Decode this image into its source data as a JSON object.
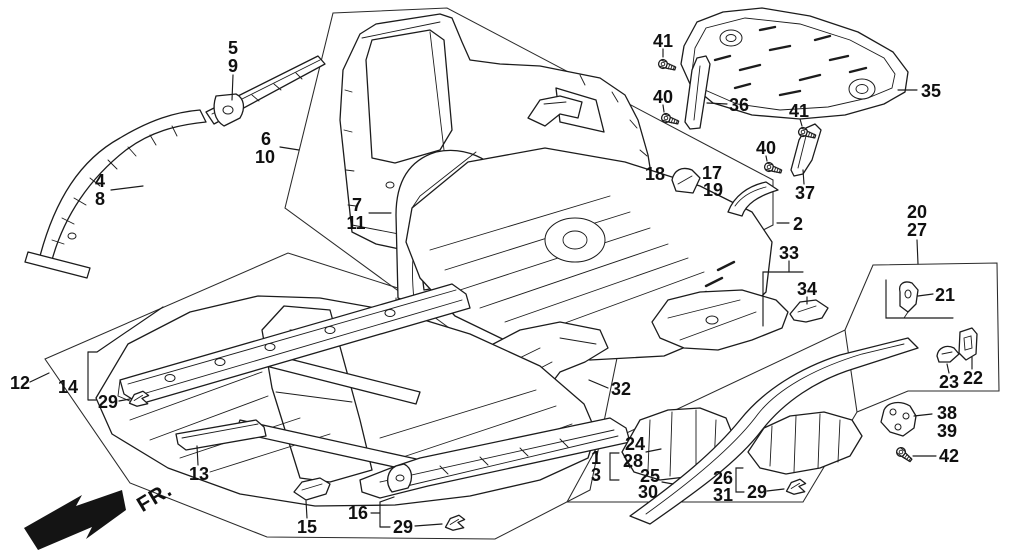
{
  "diagram": {
    "background": "#ffffff",
    "ink_color": "#1c1c1c",
    "fr_label": "FR.",
    "callouts": [
      {
        "id": "5",
        "text": "5",
        "x": 233,
        "y": 48
      },
      {
        "id": "9",
        "text": "9",
        "x": 233,
        "y": 66
      },
      {
        "id": "4",
        "text": "4",
        "x": 100,
        "y": 181
      },
      {
        "id": "8",
        "text": "8",
        "x": 100,
        "y": 199
      },
      {
        "id": "6",
        "text": "6",
        "x": 266,
        "y": 139
      },
      {
        "id": "10",
        "text": "10",
        "x": 265,
        "y": 157
      },
      {
        "id": "7",
        "text": "7",
        "x": 357,
        "y": 205
      },
      {
        "id": "11",
        "text": "11",
        "x": 356,
        "y": 223
      },
      {
        "id": "12",
        "text": "12",
        "x": 20,
        "y": 383
      },
      {
        "id": "14",
        "text": "14",
        "x": 68,
        "y": 387
      },
      {
        "id": "29a",
        "text": "29",
        "x": 108,
        "y": 402
      },
      {
        "id": "13",
        "text": "13",
        "x": 199,
        "y": 474
      },
      {
        "id": "15",
        "text": "15",
        "x": 307,
        "y": 527
      },
      {
        "id": "16",
        "text": "16",
        "x": 358,
        "y": 513
      },
      {
        "id": "29b",
        "text": "29",
        "x": 403,
        "y": 527
      },
      {
        "id": "41a",
        "text": "41",
        "x": 663,
        "y": 41
      },
      {
        "id": "40a",
        "text": "40",
        "x": 663,
        "y": 97
      },
      {
        "id": "36",
        "text": "36",
        "x": 739,
        "y": 105
      },
      {
        "id": "35",
        "text": "35",
        "x": 931,
        "y": 91
      },
      {
        "id": "41b",
        "text": "41",
        "x": 799,
        "y": 111
      },
      {
        "id": "40b",
        "text": "40",
        "x": 766,
        "y": 148
      },
      {
        "id": "37",
        "text": "37",
        "x": 805,
        "y": 193
      },
      {
        "id": "18",
        "text": "18",
        "x": 655,
        "y": 174
      },
      {
        "id": "17",
        "text": "17",
        "x": 712,
        "y": 173
      },
      {
        "id": "19",
        "text": "19",
        "x": 713,
        "y": 190
      },
      {
        "id": "2",
        "text": "2",
        "x": 798,
        "y": 224
      },
      {
        "id": "33",
        "text": "33",
        "x": 789,
        "y": 253
      },
      {
        "id": "34",
        "text": "34",
        "x": 807,
        "y": 289
      },
      {
        "id": "20",
        "text": "20",
        "x": 917,
        "y": 212
      },
      {
        "id": "27",
        "text": "27",
        "x": 917,
        "y": 230
      },
      {
        "id": "21",
        "text": "21",
        "x": 945,
        "y": 295
      },
      {
        "id": "23",
        "text": "23",
        "x": 949,
        "y": 382
      },
      {
        "id": "22",
        "text": "22",
        "x": 973,
        "y": 378
      },
      {
        "id": "38",
        "text": "38",
        "x": 947,
        "y": 413
      },
      {
        "id": "39",
        "text": "39",
        "x": 947,
        "y": 431
      },
      {
        "id": "42",
        "text": "42",
        "x": 949,
        "y": 456
      },
      {
        "id": "32",
        "text": "32",
        "x": 621,
        "y": 389
      },
      {
        "id": "1",
        "text": "1",
        "x": 596,
        "y": 458
      },
      {
        "id": "3",
        "text": "3",
        "x": 596,
        "y": 475
      },
      {
        "id": "24",
        "text": "24",
        "x": 635,
        "y": 444
      },
      {
        "id": "28",
        "text": "28",
        "x": 633,
        "y": 461
      },
      {
        "id": "25",
        "text": "25",
        "x": 650,
        "y": 476
      },
      {
        "id": "30",
        "text": "30",
        "x": 648,
        "y": 492
      },
      {
        "id": "26",
        "text": "26",
        "x": 723,
        "y": 478
      },
      {
        "id": "31",
        "text": "31",
        "x": 723,
        "y": 495
      },
      {
        "id": "29c",
        "text": "29",
        "x": 757,
        "y": 492
      }
    ],
    "leader_lines": [
      {
        "pts": [
          [
            233,
            75
          ],
          [
            232,
            100
          ]
        ]
      },
      {
        "pts": [
          [
            111,
            190
          ],
          [
            143,
            186
          ]
        ]
      },
      {
        "pts": [
          [
            280,
            147
          ],
          [
            299,
            150
          ]
        ]
      },
      {
        "pts": [
          [
            369,
            213
          ],
          [
            391,
            213
          ]
        ]
      },
      {
        "pts": [
          [
            30,
            382
          ],
          [
            49,
            373
          ]
        ]
      },
      {
        "pts": [
          [
            88,
            352
          ],
          [
            88,
            400
          ]
        ]
      },
      {
        "pts": [
          [
            88,
            352
          ],
          [
            97,
            352
          ],
          [
            163,
            307
          ]
        ]
      },
      {
        "pts": [
          [
            88,
            400
          ],
          [
            96,
            400
          ]
        ]
      },
      {
        "pts": [
          [
            119,
            401
          ],
          [
            130,
            399
          ]
        ]
      },
      {
        "pts": [
          [
            198,
            465
          ],
          [
            197,
            446
          ]
        ]
      },
      {
        "pts": [
          [
            307,
            518
          ],
          [
            306,
            501
          ]
        ]
      },
      {
        "pts": [
          [
            371,
            513
          ],
          [
            380,
            513
          ]
        ]
      },
      {
        "pts": [
          [
            380,
            502
          ],
          [
            380,
            527
          ]
        ]
      },
      {
        "pts": [
          [
            380,
            502
          ],
          [
            394,
            497
          ]
        ]
      },
      {
        "pts": [
          [
            380,
            527
          ],
          [
            390,
            527
          ]
        ]
      },
      {
        "pts": [
          [
            415,
            526
          ],
          [
            442,
            524
          ]
        ]
      },
      {
        "pts": [
          [
            663,
            49
          ],
          [
            663,
            57
          ]
        ]
      },
      {
        "pts": [
          [
            663,
            105
          ],
          [
            664,
            112
          ]
        ]
      },
      {
        "pts": [
          [
            727,
            104
          ],
          [
            707,
            103
          ]
        ]
      },
      {
        "pts": [
          [
            917,
            90
          ],
          [
            898,
            90
          ]
        ]
      },
      {
        "pts": [
          [
            800,
            119
          ],
          [
            802,
            126
          ]
        ]
      },
      {
        "pts": [
          [
            766,
            156
          ],
          [
            767,
            161
          ]
        ]
      },
      {
        "pts": [
          [
            804,
            184
          ],
          [
            803,
            170
          ]
        ]
      },
      {
        "pts": [
          [
            789,
            223
          ],
          [
            777,
            223
          ]
        ]
      },
      {
        "pts": [
          [
            789,
            261
          ],
          [
            789,
            272
          ]
        ]
      },
      {
        "pts": [
          [
            803,
            272
          ],
          [
            763,
            272
          ],
          [
            763,
            326
          ]
        ]
      },
      {
        "pts": [
          [
            807,
            297
          ],
          [
            807,
            304
          ]
        ]
      },
      {
        "pts": [
          [
            917,
            240
          ],
          [
            918,
            264
          ]
        ]
      },
      {
        "pts": [
          [
            933,
            294
          ],
          [
            918,
            296
          ]
        ]
      },
      {
        "pts": [
          [
            886,
            280
          ],
          [
            886,
            318
          ],
          [
            953,
            318
          ]
        ]
      },
      {
        "pts": [
          [
            949,
            373
          ],
          [
            947,
            364
          ]
        ]
      },
      {
        "pts": [
          [
            972,
            369
          ],
          [
            972,
            357
          ]
        ]
      },
      {
        "pts": [
          [
            932,
            414
          ],
          [
            914,
            416
          ]
        ]
      },
      {
        "pts": [
          [
            936,
            456
          ],
          [
            913,
            456
          ]
        ]
      },
      {
        "pts": [
          [
            608,
            388
          ],
          [
            589,
            380
          ]
        ]
      },
      {
        "pts": [
          [
            619,
            453
          ],
          [
            610,
            453
          ],
          [
            610,
            480
          ],
          [
            619,
            480
          ]
        ]
      },
      {
        "pts": [
          [
            646,
            452
          ],
          [
            661,
            449
          ]
        ]
      },
      {
        "pts": [
          [
            662,
            482
          ],
          [
            673,
            484
          ]
        ]
      },
      {
        "pts": [
          [
            743,
            468
          ],
          [
            736,
            468
          ],
          [
            736,
            492
          ],
          [
            744,
            492
          ]
        ]
      },
      {
        "pts": [
          [
            767,
            491
          ],
          [
            784,
            489
          ]
        ]
      }
    ],
    "group_boxes": [
      {
        "name": "group-2-outline",
        "closed": true,
        "points": [
          [
            333,
            13
          ],
          [
            447,
            8
          ],
          [
            773,
            180
          ],
          [
            773,
            225
          ],
          [
            500,
            365
          ],
          [
            393,
            287
          ],
          [
            285,
            208
          ]
        ]
      },
      {
        "name": "group-12-outline",
        "closed": true,
        "points": [
          [
            45,
            359
          ],
          [
            288,
            253
          ],
          [
            617,
            358
          ],
          [
            590,
            490
          ],
          [
            495,
            539
          ],
          [
            267,
            537
          ],
          [
            130,
            483
          ]
        ]
      },
      {
        "name": "group-1-3-outline",
        "closed": true,
        "points": [
          [
            597,
            447
          ],
          [
            845,
            330
          ],
          [
            857,
            412
          ],
          [
            803,
            502
          ],
          [
            567,
            502
          ]
        ]
      },
      {
        "name": "group-20-27-outline",
        "closed": false,
        "points": [
          [
            845,
            330
          ],
          [
            873,
            265
          ],
          [
            997,
            263
          ],
          [
            999,
            391
          ],
          [
            908,
            391
          ],
          [
            857,
            412
          ]
        ]
      }
    ],
    "bolts": [
      {
        "id": "bolt-41a",
        "x": 663,
        "y": 64,
        "rot": 18
      },
      {
        "id": "bolt-40a",
        "x": 666,
        "y": 118,
        "rot": 18
      },
      {
        "id": "bolt-41b",
        "x": 803,
        "y": 132,
        "rot": 18
      },
      {
        "id": "bolt-40b",
        "x": 769,
        "y": 167,
        "rot": 18
      },
      {
        "id": "bolt-42",
        "x": 901,
        "y": 452,
        "rot": 38
      }
    ],
    "clips": [
      {
        "id": "clip-29-left",
        "x": 138,
        "y": 399,
        "rot": -8
      },
      {
        "id": "clip-29-mid",
        "x": 454,
        "y": 523,
        "rot": -8
      },
      {
        "id": "clip-29-right",
        "x": 795,
        "y": 487,
        "rot": -8
      }
    ]
  }
}
